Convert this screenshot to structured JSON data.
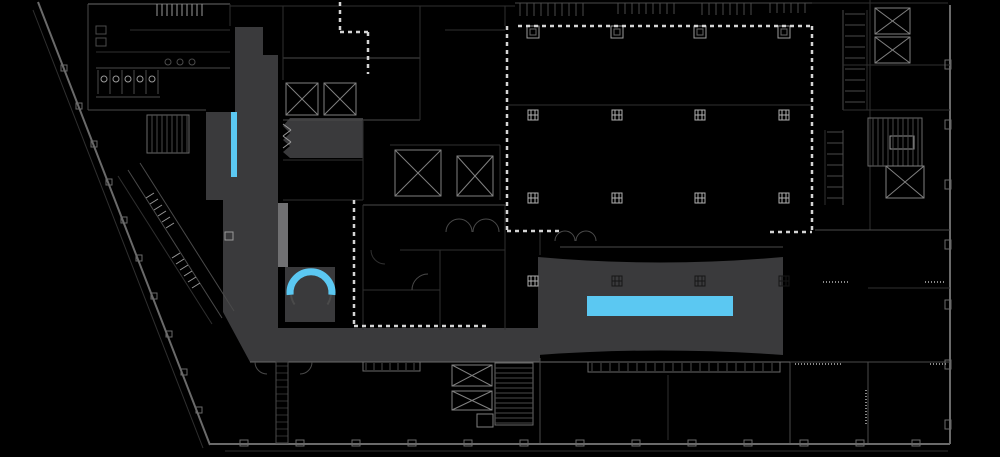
{
  "meta": {
    "description": "building-floor-plan-with-highlighted-circulation-path",
    "canvas": {
      "width": 1000,
      "height": 457
    },
    "palette": {
      "background": "#000000",
      "path_gray": "#3a3a3c",
      "escalator_light_gray": "#707072",
      "highlight_cyan": "#5bc8f2",
      "dash_white": "#d4d4d4",
      "tones": {
        "a": "#2f2f2f",
        "b": "#4a4a4a",
        "c": "#6a6a6a",
        "d": "#9a9a9a"
      }
    }
  },
  "plan": {
    "fills": [
      {
        "name": "path-corridor-top",
        "type": "polygon",
        "points": [
          [
            235,
            27
          ],
          [
            263,
            27
          ],
          [
            263,
            55
          ],
          [
            278,
            55
          ],
          [
            278,
            112
          ],
          [
            235,
            112
          ]
        ]
      },
      {
        "name": "path-wing-left",
        "type": "rect",
        "x": 206,
        "y": 112,
        "w": 72,
        "h": 88
      },
      {
        "name": "path-room-upper",
        "type": "polygon",
        "points": [
          [
            290,
            118
          ],
          [
            363,
            118
          ],
          [
            363,
            158
          ],
          [
            290,
            158
          ],
          [
            283,
            152
          ],
          [
            290,
            146
          ],
          [
            283,
            140
          ],
          [
            290,
            133
          ],
          [
            283,
            126
          ]
        ]
      },
      {
        "name": "path-corridor-main",
        "type": "polygon",
        "points": [
          [
            223,
            200
          ],
          [
            278,
            200
          ],
          [
            278,
            328
          ],
          [
            540,
            328
          ],
          [
            540,
            362
          ],
          [
            250,
            362
          ],
          [
            223,
            312
          ]
        ]
      },
      {
        "name": "path-stair-room",
        "type": "rect",
        "x": 285,
        "y": 267,
        "w": 50,
        "h": 55
      },
      {
        "name": "path-event-block",
        "type": "path",
        "d": "M538,257 Q660,268 783,257 L783,355 Q660,346 538,355 Z"
      },
      {
        "name": "escalator-strip",
        "type": "rect",
        "x": 278,
        "y": 203,
        "w": 10,
        "h": 64,
        "color": "#707072"
      }
    ],
    "highlights": [
      {
        "name": "highlight-bar-vertical",
        "type": "rect",
        "x": 231,
        "y": 112,
        "w": 6,
        "h": 65
      },
      {
        "name": "highlight-bar-long",
        "type": "rect",
        "x": 587,
        "y": 296,
        "w": 146,
        "h": 20
      },
      {
        "name": "highlight-arc-stair",
        "type": "arc",
        "cx": 311,
        "cy": 293,
        "r": 21,
        "a0": 185,
        "a1": -5,
        "w": 7
      }
    ],
    "dashed": [
      [
        340,
        2,
        340,
        32
      ],
      [
        340,
        32,
        370,
        32
      ],
      [
        368,
        32,
        368,
        74
      ],
      [
        518,
        26,
        810,
        26
      ],
      [
        507,
        26,
        507,
        232
      ],
      [
        507,
        231,
        560,
        231
      ],
      [
        812,
        26,
        812,
        232
      ],
      [
        770,
        232,
        812,
        232
      ],
      [
        354,
        200,
        354,
        327
      ],
      [
        354,
        326,
        490,
        326
      ]
    ],
    "lines": [
      [
        38,
        2,
        210,
        445,
        "c",
        2
      ],
      [
        33,
        10,
        203,
        448,
        "a",
        1
      ],
      [
        210,
        444,
        950,
        444,
        "c",
        2
      ],
      [
        225,
        451,
        948,
        451,
        "a",
        1
      ],
      [
        950,
        5,
        950,
        444,
        "c",
        2
      ],
      [
        88,
        4,
        230,
        4,
        "c",
        1
      ],
      [
        230,
        6,
        515,
        6,
        "a",
        1
      ],
      [
        515,
        3,
        812,
        3,
        "b",
        1
      ],
      [
        812,
        3,
        948,
        3,
        "a",
        1
      ],
      [
        88,
        4,
        88,
        110,
        "b",
        1
      ],
      [
        88,
        110,
        206,
        110,
        "b",
        1
      ],
      [
        230,
        4,
        230,
        26,
        "a",
        1
      ],
      [
        96,
        52,
        230,
        52,
        "a",
        1
      ],
      [
        96,
        68,
        230,
        68,
        "b",
        1
      ],
      [
        130,
        30,
        230,
        30,
        "a",
        1
      ],
      [
        96,
        97,
        160,
        97,
        "b",
        1
      ],
      [
        128,
        170,
        222,
        318,
        "b",
        1
      ],
      [
        140,
        163,
        234,
        311,
        "b",
        1
      ],
      [
        118,
        176,
        212,
        324,
        "a",
        1
      ],
      [
        146,
        198,
        154,
        193,
        "d",
        1
      ],
      [
        150,
        204,
        158,
        199,
        "d",
        1
      ],
      [
        154,
        210,
        162,
        205,
        "d",
        1
      ],
      [
        158,
        216,
        166,
        211,
        "d",
        1
      ],
      [
        162,
        222,
        170,
        217,
        "d",
        1
      ],
      [
        166,
        228,
        174,
        223,
        "d",
        1
      ],
      [
        172,
        258,
        180,
        253,
        "d",
        1
      ],
      [
        176,
        264,
        184,
        259,
        "d",
        1
      ],
      [
        180,
        270,
        188,
        265,
        "d",
        1
      ],
      [
        184,
        276,
        192,
        271,
        "d",
        1
      ],
      [
        188,
        282,
        196,
        277,
        "d",
        1
      ],
      [
        192,
        288,
        200,
        283,
        "d",
        1
      ],
      [
        283,
        58,
        420,
        58,
        "b",
        1
      ],
      [
        283,
        58,
        283,
        80,
        "a",
        1
      ],
      [
        283,
        120,
        420,
        120,
        "b",
        1
      ],
      [
        420,
        58,
        420,
        120,
        "a",
        1
      ],
      [
        283,
        160,
        363,
        160,
        "a",
        1
      ],
      [
        283,
        200,
        363,
        200,
        "a",
        1
      ],
      [
        363,
        120,
        363,
        200,
        "a",
        1
      ],
      [
        390,
        145,
        500,
        145,
        "a",
        1
      ],
      [
        500,
        145,
        500,
        200,
        "a",
        1
      ],
      [
        363,
        205,
        505,
        205,
        "b",
        1
      ],
      [
        363,
        205,
        363,
        330,
        "a",
        1
      ],
      [
        505,
        205,
        505,
        330,
        "a",
        1
      ],
      [
        400,
        250,
        505,
        250,
        "a",
        1
      ],
      [
        363,
        290,
        440,
        290,
        "a",
        1
      ],
      [
        440,
        250,
        440,
        330,
        "a",
        1
      ],
      [
        283,
        124,
        291,
        130,
        "d",
        1
      ],
      [
        291,
        130,
        283,
        136,
        "d",
        1
      ],
      [
        283,
        136,
        291,
        142,
        "d",
        1
      ],
      [
        291,
        142,
        283,
        148,
        "d",
        1
      ],
      [
        283,
        6,
        283,
        58,
        "a",
        1
      ],
      [
        420,
        6,
        420,
        58,
        "a",
        1
      ],
      [
        445,
        30,
        505,
        30,
        "a",
        1
      ],
      [
        505,
        6,
        505,
        26,
        "a",
        1
      ],
      [
        507,
        105,
        812,
        105,
        "a",
        1
      ],
      [
        560,
        247,
        783,
        247,
        "b",
        1
      ],
      [
        540,
        232,
        540,
        255,
        "a",
        1
      ],
      [
        870,
        0,
        870,
        230,
        "a",
        1
      ],
      [
        843,
        10,
        843,
        110,
        "b",
        1
      ],
      [
        867,
        10,
        867,
        110,
        "a",
        1
      ],
      [
        843,
        65,
        950,
        65,
        "a",
        1
      ],
      [
        815,
        230,
        950,
        230,
        "b",
        1
      ],
      [
        843,
        110,
        950,
        110,
        "a",
        1
      ],
      [
        825,
        130,
        825,
        205,
        "a",
        1
      ],
      [
        843,
        130,
        843,
        205,
        "b",
        1
      ],
      [
        868,
        288,
        950,
        288,
        "a",
        1
      ],
      [
        790,
        362,
        950,
        362,
        "b",
        1
      ],
      [
        868,
        362,
        868,
        443,
        "b",
        1
      ],
      [
        790,
        362,
        790,
        443,
        "b",
        1
      ],
      [
        250,
        362,
        790,
        362,
        "c",
        1
      ],
      [
        540,
        358,
        540,
        443,
        "b",
        1
      ],
      [
        668,
        375,
        668,
        440,
        "a",
        1
      ]
    ],
    "microtext": [
      [
        795,
        364,
        842,
        364
      ],
      [
        925,
        282,
        944,
        282
      ],
      [
        823,
        282,
        848,
        282
      ],
      [
        866,
        390,
        866,
        424
      ],
      [
        930,
        364,
        948,
        364
      ]
    ],
    "arcs": [
      {
        "cx": 459,
        "cy": 232,
        "r": 13,
        "a0": 180,
        "a1": 0,
        "t": "b"
      },
      {
        "cx": 486,
        "cy": 232,
        "r": 13,
        "a0": 180,
        "a1": 0,
        "t": "b"
      },
      {
        "cx": 565,
        "cy": 241,
        "r": 10,
        "a0": 180,
        "a1": 0,
        "t": "b"
      },
      {
        "cx": 586,
        "cy": 241,
        "r": 10,
        "a0": 180,
        "a1": 0,
        "t": "b"
      },
      {
        "cx": 428,
        "cy": 290,
        "r": 16,
        "a0": 180,
        "a1": 90,
        "t": "b"
      },
      {
        "cx": 385,
        "cy": 250,
        "r": 14,
        "a0": 270,
        "a1": 180,
        "t": "a"
      },
      {
        "cx": 267,
        "cy": 362,
        "r": 12,
        "a0": 270,
        "a1": 180,
        "t": "b"
      },
      {
        "cx": 300,
        "cy": 362,
        "r": 12,
        "a0": 360,
        "a1": 270,
        "t": "b"
      },
      {
        "cx": 311,
        "cy": 293,
        "r": 20,
        "a0": 215,
        "a1": 185,
        "t": "b",
        "w": 2
      },
      {
        "cx": 311,
        "cy": 293,
        "r": 20,
        "a0": -5,
        "a1": -35,
        "t": "b",
        "w": 2
      }
    ],
    "circles": [
      {
        "cx": 104,
        "cy": 79,
        "r": 3,
        "t": "d"
      },
      {
        "cx": 116,
        "cy": 79,
        "r": 3,
        "t": "d"
      },
      {
        "cx": 128,
        "cy": 79,
        "r": 3,
        "t": "d"
      },
      {
        "cx": 140,
        "cy": 79,
        "r": 3,
        "t": "d"
      },
      {
        "cx": 152,
        "cy": 79,
        "r": 3,
        "t": "d"
      },
      {
        "cx": 168,
        "cy": 62,
        "r": 3,
        "t": "b"
      },
      {
        "cx": 180,
        "cy": 62,
        "r": 3,
        "t": "b"
      },
      {
        "cx": 192,
        "cy": 62,
        "r": 3,
        "t": "b"
      }
    ],
    "combs": [
      {
        "x": 157,
        "y": 4,
        "dir": "h",
        "len": 48,
        "step": 5,
        "tick": 12,
        "t": "d"
      },
      {
        "x": 520,
        "y": 3,
        "dir": "h",
        "len": 66,
        "step": 7,
        "tick": 13,
        "t": "b"
      },
      {
        "x": 618,
        "y": 3,
        "dir": "h",
        "len": 56,
        "step": 7,
        "tick": 11,
        "t": "b"
      },
      {
        "x": 702,
        "y": 3,
        "dir": "h",
        "len": 54,
        "step": 7,
        "tick": 12,
        "t": "b"
      },
      {
        "x": 770,
        "y": 3,
        "dir": "h",
        "len": 40,
        "step": 7,
        "tick": 10,
        "t": "b"
      },
      {
        "x": 845,
        "y": 14,
        "dir": "v",
        "len": 92,
        "step": 11,
        "tick": 20,
        "t": "b"
      },
      {
        "x": 827,
        "y": 132,
        "dir": "v",
        "len": 70,
        "step": 11,
        "tick": 16,
        "t": "b"
      },
      {
        "x": 276,
        "y": 366,
        "dir": "v",
        "len": 74,
        "step": 7,
        "tick": 12,
        "t": "a"
      },
      {
        "x": 592,
        "y": 363,
        "dir": "h",
        "len": 184,
        "step": 9,
        "tick": 8,
        "t": "b"
      },
      {
        "x": 366,
        "y": 363,
        "dir": "h",
        "len": 51,
        "step": 8,
        "tick": 7,
        "t": "b"
      },
      {
        "x": 98,
        "y": 70,
        "dir": "h",
        "len": 60,
        "step": 12,
        "tick": 24,
        "t": "b"
      }
    ],
    "rect_outlines": [
      {
        "x": 276,
        "y": 362,
        "w": 12,
        "h": 81,
        "t": "b"
      },
      {
        "x": 588,
        "y": 362,
        "w": 192,
        "h": 10,
        "t": "c"
      },
      {
        "x": 363,
        "y": 362,
        "w": 57,
        "h": 9,
        "t": "c"
      },
      {
        "x": 890,
        "y": 136,
        "w": 24,
        "h": 13,
        "t": "d"
      },
      {
        "x": 225,
        "y": 232,
        "w": 8,
        "h": 8,
        "t": "d"
      },
      {
        "x": 96,
        "y": 26,
        "w": 10,
        "h": 8,
        "t": "b"
      },
      {
        "x": 96,
        "y": 38,
        "w": 10,
        "h": 8,
        "t": "b"
      }
    ],
    "elevators": [
      {
        "x": 286,
        "y": 83,
        "w": 32,
        "h": 32
      },
      {
        "x": 324,
        "y": 83,
        "w": 32,
        "h": 32
      },
      {
        "x": 395,
        "y": 150,
        "w": 46,
        "h": 46
      },
      {
        "x": 457,
        "y": 156,
        "w": 36,
        "h": 40
      },
      {
        "x": 875,
        "y": 8,
        "w": 35,
        "h": 26
      },
      {
        "x": 875,
        "y": 37,
        "w": 35,
        "h": 26
      },
      {
        "x": 886,
        "y": 166,
        "w": 38,
        "h": 32
      },
      {
        "x": 452,
        "y": 365,
        "w": 40,
        "h": 21
      },
      {
        "x": 452,
        "y": 391,
        "w": 40,
        "h": 19
      },
      {
        "x": 477,
        "y": 414,
        "w": 16,
        "h": 13,
        "noX": true
      }
    ],
    "stairs": [
      {
        "x": 147,
        "y": 115,
        "w": 42,
        "h": 38,
        "treads": "v"
      },
      {
        "x": 868,
        "y": 118,
        "w": 54,
        "h": 48,
        "treads": "v"
      },
      {
        "x": 495,
        "y": 363,
        "w": 38,
        "h": 62,
        "treads": "h"
      }
    ],
    "columns": {
      "cols": [
        533,
        617,
        700,
        784
      ],
      "rows": [
        115,
        198,
        281
      ],
      "dark": [
        "617,281",
        "700,281",
        "784,281"
      ],
      "stub_xs": [
        533,
        617,
        700,
        784
      ],
      "stub_y": 26
    },
    "pilasters": {
      "diagonal": [
        [
          64,
          68
        ],
        [
          79,
          106
        ],
        [
          94,
          144
        ],
        [
          109,
          182
        ],
        [
          124,
          220
        ],
        [
          139,
          258
        ],
        [
          154,
          296
        ],
        [
          169,
          334
        ],
        [
          184,
          372
        ],
        [
          199,
          410
        ]
      ],
      "bottom_xs": [
        240,
        296,
        352,
        408,
        464,
        520,
        576,
        632,
        688,
        744,
        800,
        856,
        912
      ],
      "bottom_y": 440,
      "right_ys": [
        60,
        120,
        180,
        240,
        300,
        360,
        420
      ],
      "right_x": 945
    }
  }
}
